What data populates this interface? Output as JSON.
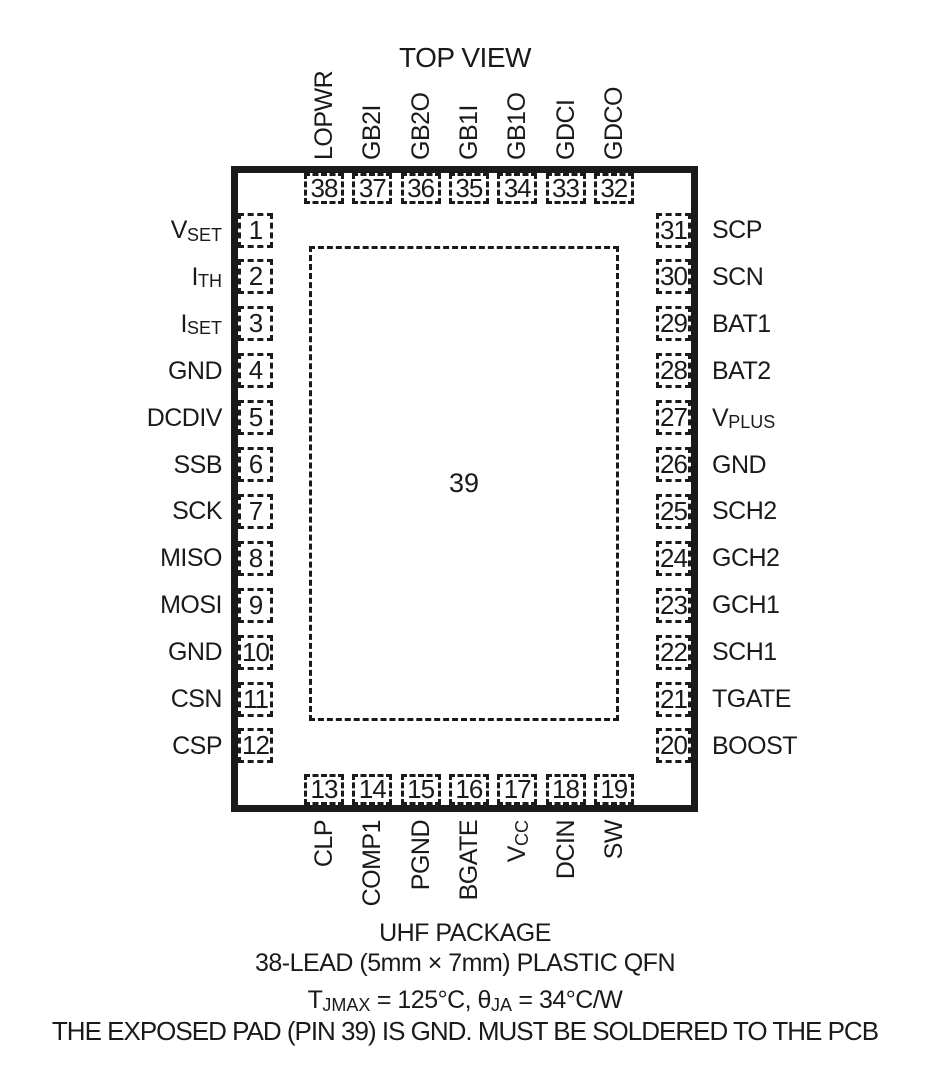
{
  "title": "TOP VIEW",
  "center_pad": {
    "number": "39"
  },
  "pins": {
    "left": [
      {
        "num": "1",
        "label": [
          {
            "t": "V"
          },
          {
            "t": "SET",
            "sub": true
          }
        ]
      },
      {
        "num": "2",
        "label": [
          {
            "t": "I"
          },
          {
            "t": "TH",
            "sub": true
          }
        ]
      },
      {
        "num": "3",
        "label": [
          {
            "t": "I"
          },
          {
            "t": "SET",
            "sub": true
          }
        ]
      },
      {
        "num": "4",
        "label": [
          {
            "t": "GND"
          }
        ]
      },
      {
        "num": "5",
        "label": [
          {
            "t": "DCDIV"
          }
        ]
      },
      {
        "num": "6",
        "label": [
          {
            "t": "SSB"
          }
        ]
      },
      {
        "num": "7",
        "label": [
          {
            "t": "SCK"
          }
        ]
      },
      {
        "num": "8",
        "label": [
          {
            "t": "MISO"
          }
        ]
      },
      {
        "num": "9",
        "label": [
          {
            "t": "MOSI"
          }
        ]
      },
      {
        "num": "10",
        "label": [
          {
            "t": "GND"
          }
        ]
      },
      {
        "num": "11",
        "label": [
          {
            "t": "CSN"
          }
        ]
      },
      {
        "num": "12",
        "label": [
          {
            "t": "CSP"
          }
        ]
      }
    ],
    "right": [
      {
        "num": "31",
        "label": [
          {
            "t": "SCP"
          }
        ]
      },
      {
        "num": "30",
        "label": [
          {
            "t": "SCN"
          }
        ]
      },
      {
        "num": "29",
        "label": [
          {
            "t": "BAT1"
          }
        ]
      },
      {
        "num": "28",
        "label": [
          {
            "t": "BAT2"
          }
        ]
      },
      {
        "num": "27",
        "label": [
          {
            "t": "V"
          },
          {
            "t": "PLUS",
            "sub": true
          }
        ]
      },
      {
        "num": "26",
        "label": [
          {
            "t": "GND"
          }
        ]
      },
      {
        "num": "25",
        "label": [
          {
            "t": "SCH2"
          }
        ]
      },
      {
        "num": "24",
        "label": [
          {
            "t": "GCH2"
          }
        ]
      },
      {
        "num": "23",
        "label": [
          {
            "t": "GCH1"
          }
        ]
      },
      {
        "num": "22",
        "label": [
          {
            "t": "SCH1"
          }
        ]
      },
      {
        "num": "21",
        "label": [
          {
            "t": "TGATE"
          }
        ]
      },
      {
        "num": "20",
        "label": [
          {
            "t": "BOOST"
          }
        ]
      }
    ],
    "top": [
      {
        "num": "38",
        "label": [
          {
            "t": "LOPWR"
          }
        ]
      },
      {
        "num": "37",
        "label": [
          {
            "t": "GB2I"
          }
        ]
      },
      {
        "num": "36",
        "label": [
          {
            "t": "GB2O"
          }
        ]
      },
      {
        "num": "35",
        "label": [
          {
            "t": "GB1I"
          }
        ]
      },
      {
        "num": "34",
        "label": [
          {
            "t": "GB1O"
          }
        ]
      },
      {
        "num": "33",
        "label": [
          {
            "t": "GDCI"
          }
        ]
      },
      {
        "num": "32",
        "label": [
          {
            "t": "GDCO"
          }
        ]
      }
    ],
    "bottom": [
      {
        "num": "13",
        "label": [
          {
            "t": "CLP"
          }
        ]
      },
      {
        "num": "14",
        "label": [
          {
            "t": "COMP1"
          }
        ]
      },
      {
        "num": "15",
        "label": [
          {
            "t": "PGND"
          }
        ]
      },
      {
        "num": "16",
        "label": [
          {
            "t": "BGATE"
          }
        ]
      },
      {
        "num": "17",
        "label": [
          {
            "t": "V"
          },
          {
            "t": "CC",
            "sub": true
          }
        ]
      },
      {
        "num": "18",
        "label": [
          {
            "t": "DCIN"
          }
        ]
      },
      {
        "num": "19",
        "label": [
          {
            "t": "SW"
          }
        ]
      }
    ]
  },
  "footer": {
    "package_name": "UHF PACKAGE",
    "package_desc": "38-LEAD (5mm × 7mm) PLASTIC QFN",
    "thermal": [
      {
        "t": "T"
      },
      {
        "t": "JMAX",
        "sub": true
      },
      {
        "t": " = 125°C, θ"
      },
      {
        "t": "JA",
        "sub": true
      },
      {
        "t": " = 34°C/W"
      }
    ],
    "note": "THE EXPOSED PAD (PIN 39) IS GND. MUST BE SOLDERED TO THE PCB"
  },
  "colors": {
    "ink": "#1a1a1a",
    "background": "#ffffff"
  }
}
